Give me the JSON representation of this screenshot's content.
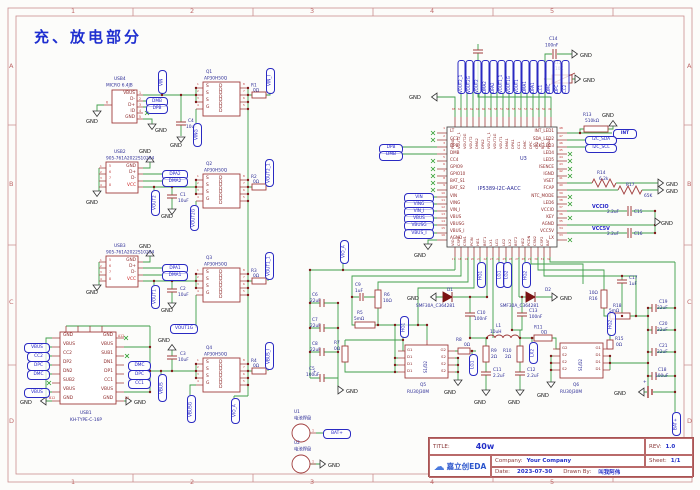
{
  "title": "充、放电部分",
  "frame": {
    "cols": [
      "1",
      "2",
      "3",
      "4",
      "5"
    ],
    "rows": [
      "A",
      "B",
      "C",
      "D"
    ]
  },
  "colors": {
    "wire_green": "#3f9e4a",
    "symbol_red": "#a03c3c",
    "net_blue": "#2222c8",
    "chip_outline": "#4a4a4a"
  },
  "nets": {
    "gnd": "GND",
    "vin": "VIN",
    "ving": "VING",
    "vin_i": "VIN_I",
    "vbus": "VBUS",
    "vbusg": "VBUSG",
    "vbus_i": "VBUS_I",
    "vout2": "VOUT2",
    "vout2g": "VOUT2G",
    "vout2_1": "VOUT2_1",
    "vout1": "VOUT1",
    "vout1g": "VOUT1G",
    "vout1_1": "VOUT1_1",
    "dmb": "DMB",
    "dpb": "DPB",
    "dpa2": "DPA2",
    "dma2": "DMA2",
    "dpa1": "DPA1",
    "dma1": "DMA1",
    "dmc": "DMC",
    "dpc": "DPC",
    "cc1": "CC1",
    "cc2": "CC2",
    "vio_a": "VIO_A",
    "bat_plus": "BAT+",
    "int": "INT",
    "i2c_sda": "I2C_SDA",
    "i2c_scl": "I2C_SCL",
    "vccio": "VCCIO",
    "vcc5v": "VCC5V",
    "hg1": "HG1",
    "lg1": "LG1",
    "lg2": "LG2",
    "hg2": "HG2",
    "lx2": "LX2",
    "a12": "A12",
    "b12": "B12",
    "a1": "A1"
  },
  "parts": {
    "usb4": {
      "ref": "USB4",
      "val": "MICRO 6.4JB",
      "pin_nums": [
        "1",
        "2",
        "3",
        "4",
        "5"
      ],
      "pin_names": [
        "VBUS",
        "D-",
        "D+",
        "ID",
        "GND"
      ],
      "pin6": "6"
    },
    "usb2": {
      "ref": "USB2",
      "val": "905-761A2022S10204",
      "pin_nums": [
        "5",
        "6",
        "7",
        "8"
      ],
      "pin_names": [
        "GND",
        "D+",
        "D-",
        "VCC"
      ],
      "left_nums": [
        "1",
        "2",
        "3",
        "4"
      ]
    },
    "usb3": {
      "ref": "USB3",
      "val": "905-761A2022S10204",
      "pin_nums": [
        "5",
        "6",
        "7",
        "8"
      ],
      "pin_names": [
        "GND",
        "D+",
        "D-",
        "VCC"
      ],
      "left_nums": [
        "1",
        "2",
        "3",
        "4"
      ]
    },
    "usb1": {
      "ref": "USB1",
      "val": "KH-TYPE-C-16P",
      "left_names": [
        "GND",
        "VBUS",
        "CC2",
        "DP2",
        "DN2",
        "SUB2",
        "VBUS",
        "GND"
      ],
      "right_names": [
        "GND",
        "VBUS",
        "SUB1",
        "DN1",
        "DP1",
        "CC1",
        "VBUS",
        "GND"
      ]
    },
    "q_pins": {
      "s_col": [
        "S",
        "S",
        "S",
        "G"
      ],
      "d_col": [
        "D D",
        "D D",
        "D D",
        "D D"
      ],
      "lnums": [
        "1",
        "2",
        "3",
        "4"
      ],
      "rnums": [
        "8",
        "7",
        "6",
        "5"
      ]
    },
    "q1": {
      "ref": "Q1",
      "val": "AP30H50Q"
    },
    "q2": {
      "ref": "Q2",
      "val": "AP30H50Q"
    },
    "q3": {
      "ref": "Q3",
      "val": "AP30H50Q"
    },
    "q4": {
      "ref": "Q4",
      "val": "AP30H50Q"
    },
    "q5": {
      "ref": "Q5",
      "val": "RU30J30M",
      "left": [
        "G1",
        "D1",
        "D1",
        "D1"
      ],
      "mid": "S1/D2",
      "right": [
        "G2",
        "S2",
        "S2",
        "S2"
      ]
    },
    "q6": {
      "ref": "Q6",
      "val": "RU30J30M",
      "left": [
        "G2",
        "S2",
        "S2",
        "S2"
      ],
      "mid": "S1/D2",
      "right": [
        "G1",
        "D1",
        "D1",
        "D1"
      ]
    },
    "u1": {
      "ref": "U1",
      "val": "电池焊盘",
      "pin": "1"
    },
    "u2": {
      "ref": "U2",
      "val": "电池焊盘",
      "pin": "1"
    },
    "u3": {
      "ref": "U3",
      "val": "IP5389-I2C-AACC",
      "left_pins": [
        {
          "n": "1",
          "name": "LT"
        },
        {
          "n": "2",
          "name": "CC3"
        },
        {
          "n": "3",
          "name": "DPB"
        },
        {
          "n": "4",
          "name": "DMB"
        },
        {
          "n": "5",
          "name": "CC4"
        },
        {
          "n": "6",
          "name": "GPIO9"
        },
        {
          "n": "7",
          "name": "GPIO10"
        },
        {
          "n": "8",
          "name": "BAT_S1"
        },
        {
          "n": "9",
          "name": "BAT_S2"
        },
        {
          "n": "10",
          "name": "VIN"
        },
        {
          "n": "11",
          "name": "VING"
        },
        {
          "n": "12",
          "name": "VIN_I"
        },
        {
          "n": "13",
          "name": "VBUS"
        },
        {
          "n": "14",
          "name": "VBUSG"
        },
        {
          "n": "15",
          "name": "VBUS_I"
        },
        {
          "n": "16",
          "name": "AGND"
        }
      ],
      "right_pins": [
        {
          "n": "48",
          "name": "INT_LED1"
        },
        {
          "n": "47",
          "name": "SDA_LED2"
        },
        {
          "n": "46",
          "name": "SCK_LED3"
        },
        {
          "n": "45",
          "name": "LED4"
        },
        {
          "n": "44",
          "name": "LED5"
        },
        {
          "n": "43",
          "name": "ISENCE"
        },
        {
          "n": "42",
          "name": "IGND"
        },
        {
          "n": "41",
          "name": "VSET"
        },
        {
          "n": "40",
          "name": "FCAP"
        },
        {
          "n": "39",
          "name": "NTC_MODE"
        },
        {
          "n": "38",
          "name": "LED6"
        },
        {
          "n": "37",
          "name": "VCCIO"
        },
        {
          "n": "36",
          "name": "KEY"
        },
        {
          "n": "35",
          "name": "AGND"
        },
        {
          "n": "34",
          "name": "VCC5V"
        },
        {
          "n": "33",
          "name": "LX"
        }
      ],
      "top_pins": [
        {
          "n": "65",
          "name": "PGND"
        },
        {
          "n": "64",
          "name": "VOUT2_1"
        },
        {
          "n": "63",
          "name": "VOUT2G"
        },
        {
          "n": "62",
          "name": "VOUT2"
        },
        {
          "n": "61",
          "name": "DMA2"
        },
        {
          "n": "60",
          "name": "DPA2"
        },
        {
          "n": "59",
          "name": "VOUT1_1"
        },
        {
          "n": "58",
          "name": "VOUT1G"
        },
        {
          "n": "57",
          "name": "VOUT1"
        },
        {
          "n": "56",
          "name": "DMA1"
        },
        {
          "n": "55",
          "name": "DPA1"
        },
        {
          "n": "54",
          "name": "CC1"
        },
        {
          "n": "53",
          "name": "DMC"
        },
        {
          "n": "52",
          "name": "DPC"
        },
        {
          "n": "51",
          "name": "CC2"
        },
        {
          "n": "50",
          "name": "NTC"
        },
        {
          "n": "49",
          "name": "PMAX"
        }
      ],
      "bottom_pins": [
        {
          "n": "17",
          "name": "VIO"
        },
        {
          "n": "18",
          "name": "CSP1"
        },
        {
          "n": "19",
          "name": "CSN1"
        },
        {
          "n": "20",
          "name": "PCIN"
        },
        {
          "n": "21",
          "name": "HG1"
        },
        {
          "n": "22",
          "name": "BST1"
        },
        {
          "n": "23",
          "name": "LX1"
        },
        {
          "n": "24",
          "name": "LG1"
        },
        {
          "n": "25",
          "name": "LG2"
        },
        {
          "n": "26",
          "name": "LX2"
        },
        {
          "n": "27",
          "name": "BST2"
        },
        {
          "n": "28",
          "name": "HG2"
        },
        {
          "n": "29",
          "name": "PCDN"
        },
        {
          "n": "30",
          "name": "CSN2"
        },
        {
          "n": "31",
          "name": "CSP2"
        },
        {
          "n": "32",
          "name": "BAT"
        }
      ],
      "top_netlabels": [
        "VOUT2_1",
        "VOUT2G",
        "VOUT2",
        "DMA2",
        "DPA2",
        "VOUT1_1",
        "VOUT1G",
        "VOUT1",
        "DMA1",
        "DPA1",
        "CC1",
        "DMC",
        "DPC",
        "CC2"
      ]
    },
    "r1": {
      "ref": "R1",
      "val": "0Ω"
    },
    "r2": {
      "ref": "R2",
      "val": "0Ω"
    },
    "r3": {
      "ref": "R3",
      "val": "0Ω"
    },
    "r4": {
      "ref": "R4",
      "val": "0Ω"
    },
    "r5": {
      "ref": "R5",
      "val": "5mΩ"
    },
    "r6": {
      "ref": "R6",
      "val": "10Ω"
    },
    "r7": {
      "ref": "R7",
      "val": "0Ω"
    },
    "r8": {
      "ref": "R8",
      "val": "0Ω"
    },
    "r9": {
      "ref": "R9",
      "val": "2Ω"
    },
    "r10": {
      "ref": "R10",
      "val": "2Ω"
    },
    "r11": {
      "ref": "R11",
      "val": "0Ω"
    },
    "r12": {
      "ref": "R12",
      "val": "10K"
    },
    "r13": {
      "ref": "R13",
      "val": "510kΩ"
    },
    "r14": {
      "ref": "R14",
      "val": "6.2k"
    },
    "r15": {
      "ref": "R15",
      "val": "0Ω"
    },
    "r16": {
      "ref": "R16",
      "val": "10Ω"
    },
    "r17": {
      "ref": "R17",
      "val": "65K"
    },
    "r18": {
      "ref": "R18",
      "val": "5mΩ"
    },
    "c1": {
      "ref": "C1",
      "val": "10uF"
    },
    "c2": {
      "ref": "C2",
      "val": "10uF"
    },
    "c3": {
      "ref": "C3",
      "val": "10uF"
    },
    "c4": {
      "ref": "C4",
      "val": "10uF"
    },
    "c5": {
      "ref": "C5",
      "val": "100uF"
    },
    "c6": {
      "ref": "C6",
      "val": "22uF"
    },
    "c7": {
      "ref": "C7",
      "val": "22uF"
    },
    "c8": {
      "ref": "C8",
      "val": "22uF"
    },
    "c9": {
      "ref": "C9",
      "val": "1uF"
    },
    "c10": {
      "ref": "C10",
      "val": "100nF"
    },
    "c11": {
      "ref": "C11",
      "val": "2.2uF"
    },
    "c12": {
      "ref": "C12",
      "val": "2.2uF"
    },
    "c13": {
      "ref": "C13",
      "val": "100nF"
    },
    "c14": {
      "ref": "C14",
      "val": "100nF"
    },
    "c15": {
      "ref": "C15",
      "val": "2.2uF"
    },
    "c16": {
      "ref": "C16",
      "val": "2.2uF"
    },
    "c17": {
      "ref": "C17",
      "val": "1uF"
    },
    "c18": {
      "ref": "C18",
      "val": "100uF"
    },
    "c19": {
      "ref": "C19",
      "val": "22uF"
    },
    "c20": {
      "ref": "C20",
      "val": "22uF"
    },
    "c21": {
      "ref": "C21",
      "val": "22uF"
    },
    "d1": {
      "ref": "D1",
      "val": "SMF30A_C364281"
    },
    "d2": {
      "ref": "D2",
      "val": "SMF30A_C364281"
    },
    "l1": {
      "ref": "L1",
      "val": "10uH"
    }
  },
  "title_block": {
    "title_label": "TITLE:",
    "title_value": "40w",
    "rev_label": "REV:",
    "rev_value": "1.0",
    "company_label": "Company:",
    "company_value": "Your Company",
    "sheet_label": "Sheet:",
    "sheet_value": "1/1",
    "date_label": "Date:",
    "date_value": "2023-07-30",
    "drawn_label": "Drawn By:",
    "drawn_value": "叫我阿伟",
    "logo_text": "嘉立创EDA"
  }
}
